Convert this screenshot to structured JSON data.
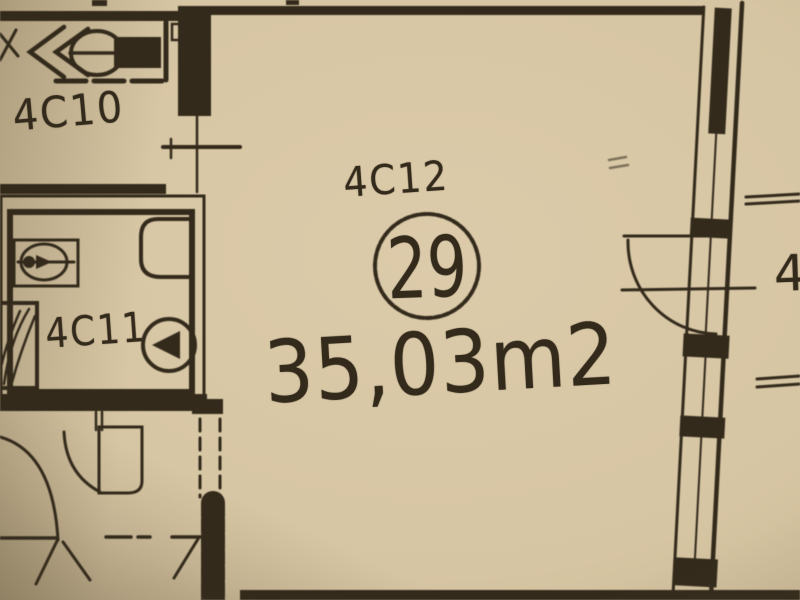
{
  "colors": {
    "paper": "#d7c6a4",
    "paper_shadow": "#8f7d5c",
    "ink": "#332a1c"
  },
  "labels": {
    "unit_top_left": "4C10",
    "bathroom": "4C11",
    "main_room": "4C12",
    "main_room_number": "29",
    "main_room_area": "35,03m2",
    "adjacent_unit_partial": "4"
  },
  "icons": {
    "toilet": "circle-with-left-arrow",
    "washbasin": "rect-with-oval-and-crossline",
    "shower_tray": "square-with-diagonal-hatching",
    "wc_fixture": "oval-with-chevrons-and-filled-block",
    "door_swing": "quarter-circle-arc",
    "window_wall": "double-line-with-filled-mullions",
    "partition_dashed": "dashed-double-line"
  }
}
